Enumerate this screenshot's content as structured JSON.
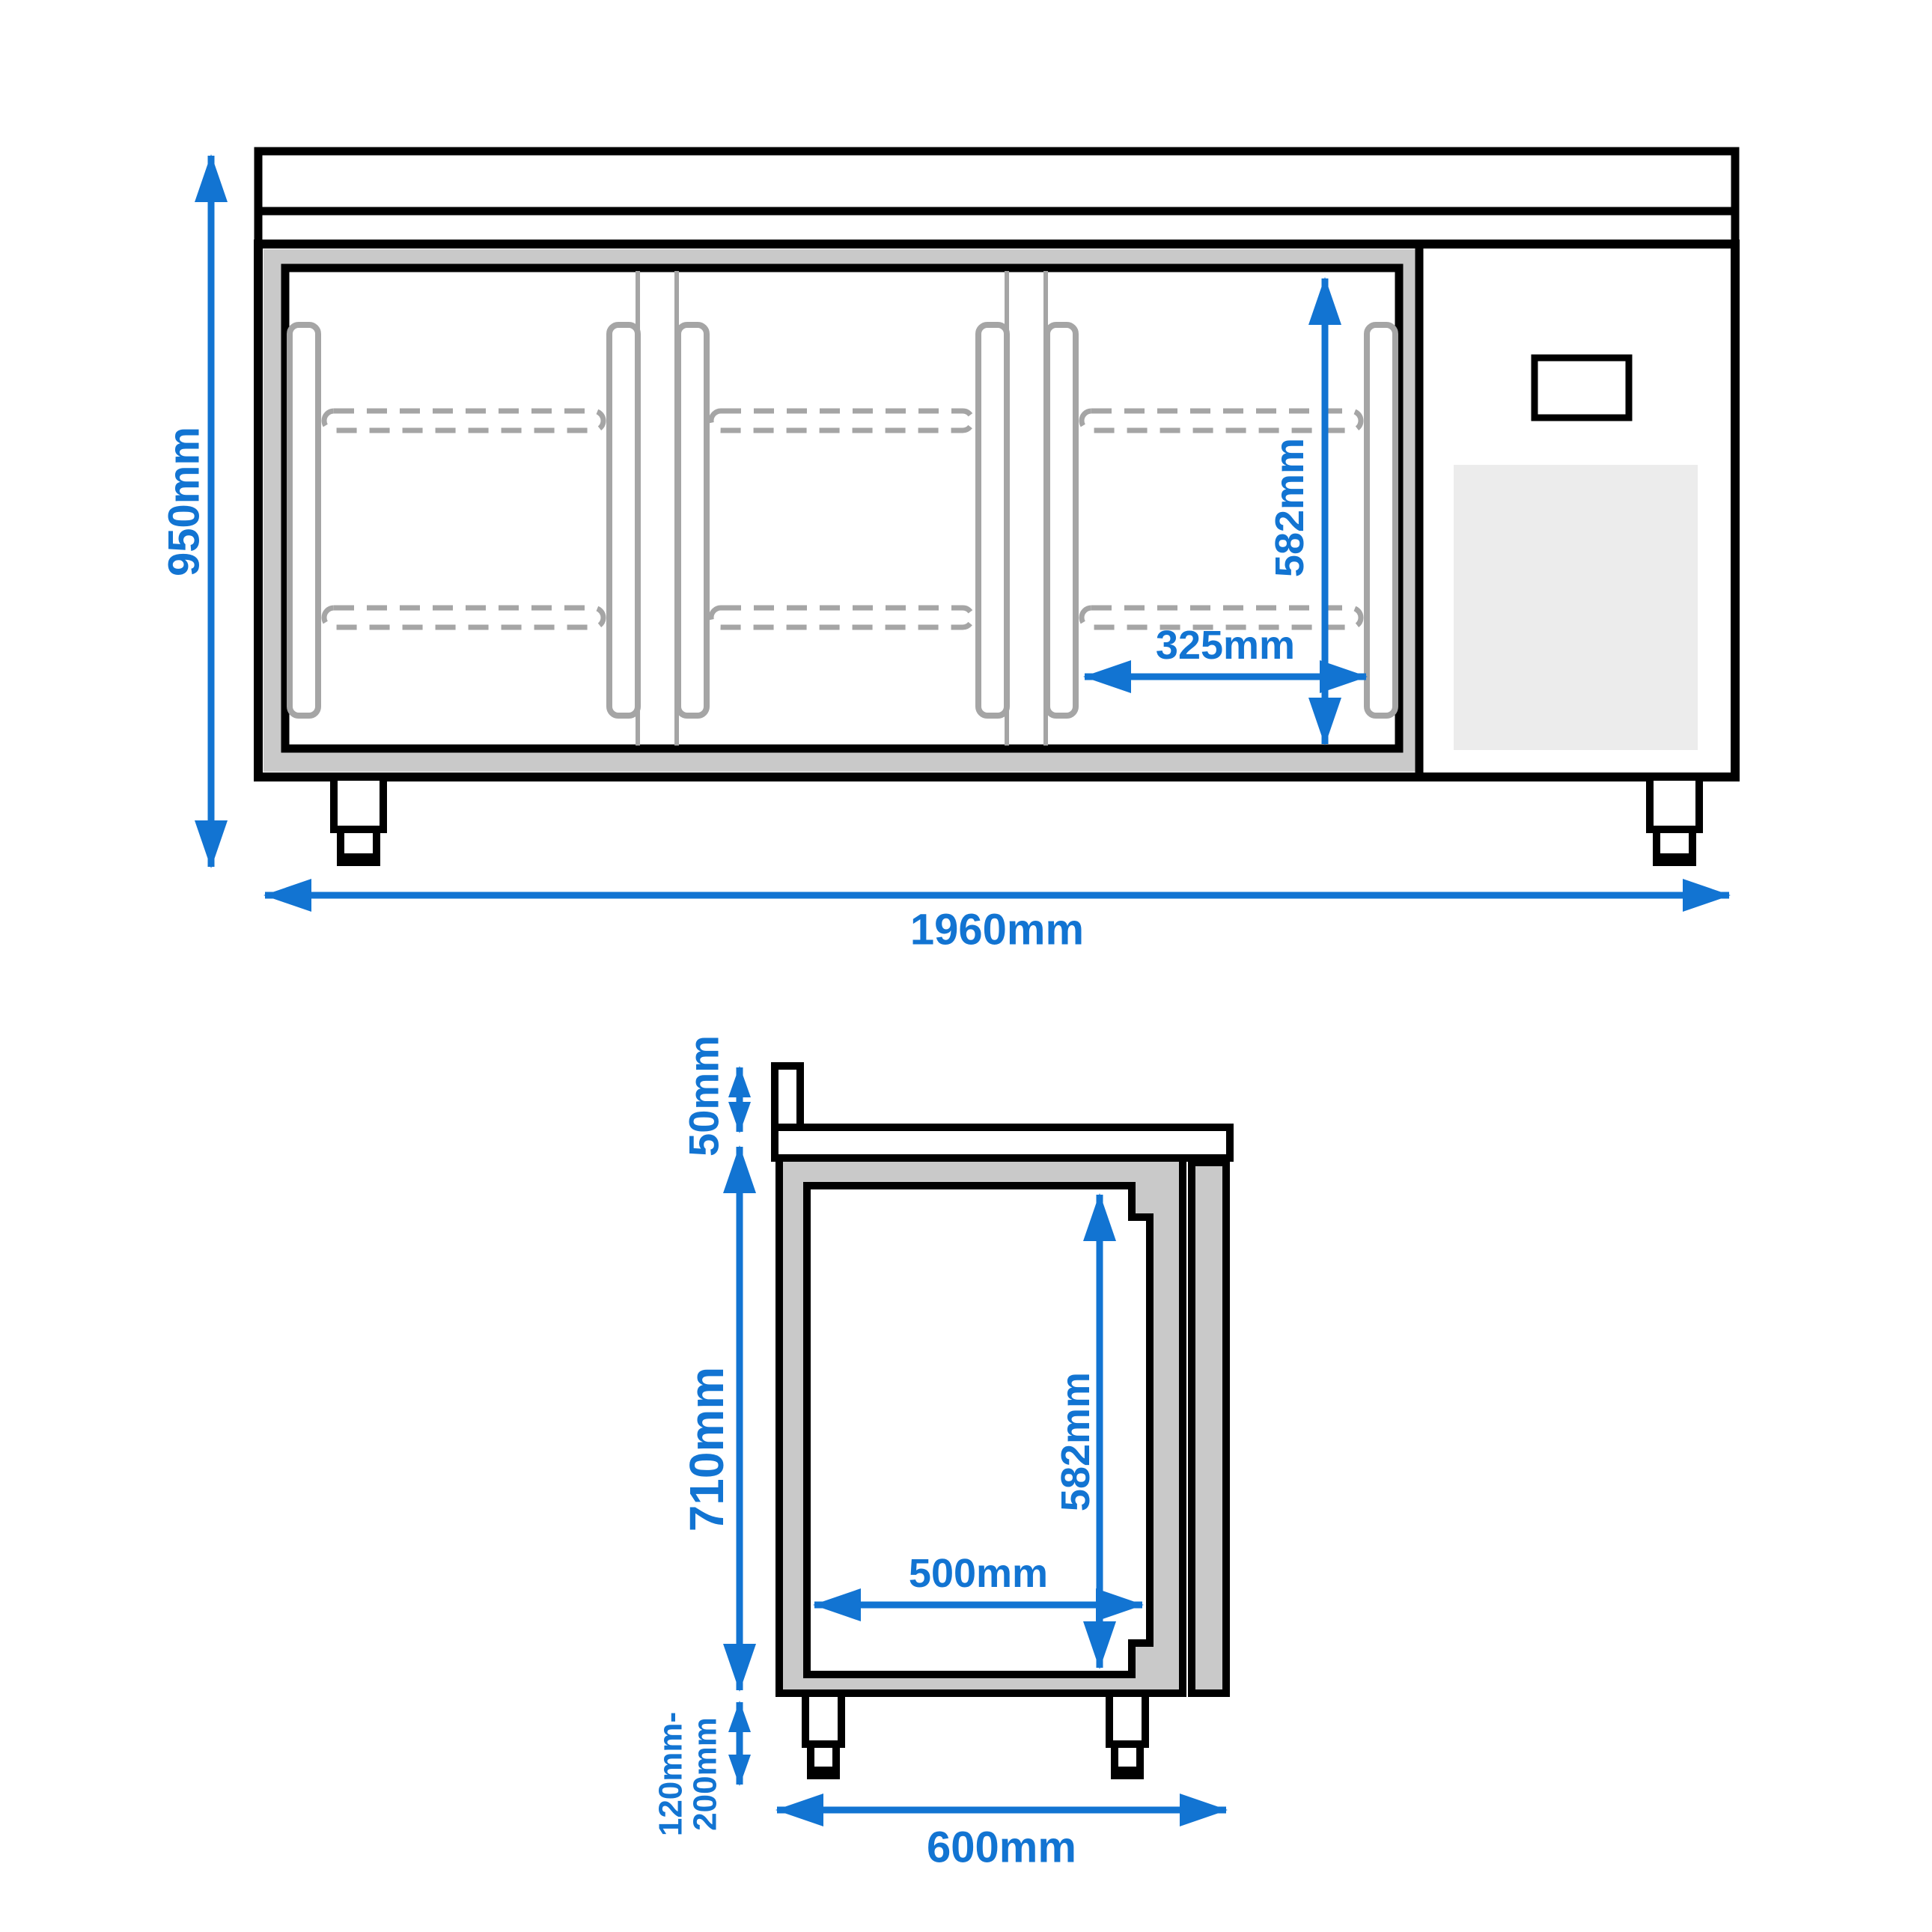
{
  "drawing": {
    "type": "technical-dimension-drawing",
    "subject": "refrigerated counter with three doors, worktop and compressor compartment"
  },
  "colors": {
    "dimension_blue": "#1274d2",
    "outline_black": "#000000",
    "panel_gray": "#c9c9c9",
    "grille_gray": "#ececec",
    "detail_gray": "#a5a5a5",
    "background": "#ffffff"
  },
  "front_view": {
    "dimensions": {
      "overall_height": "950mm",
      "overall_width": "1960mm",
      "inner_height": "582mm",
      "door_opening_width": "325mm"
    }
  },
  "side_view": {
    "dimensions": {
      "backsplash_height": "50mm",
      "body_height": "710mm",
      "leg_height_min": "120mm-",
      "leg_height_max": "200mm",
      "inner_height": "582mm",
      "inner_depth": "500mm",
      "overall_depth": "600mm"
    }
  }
}
